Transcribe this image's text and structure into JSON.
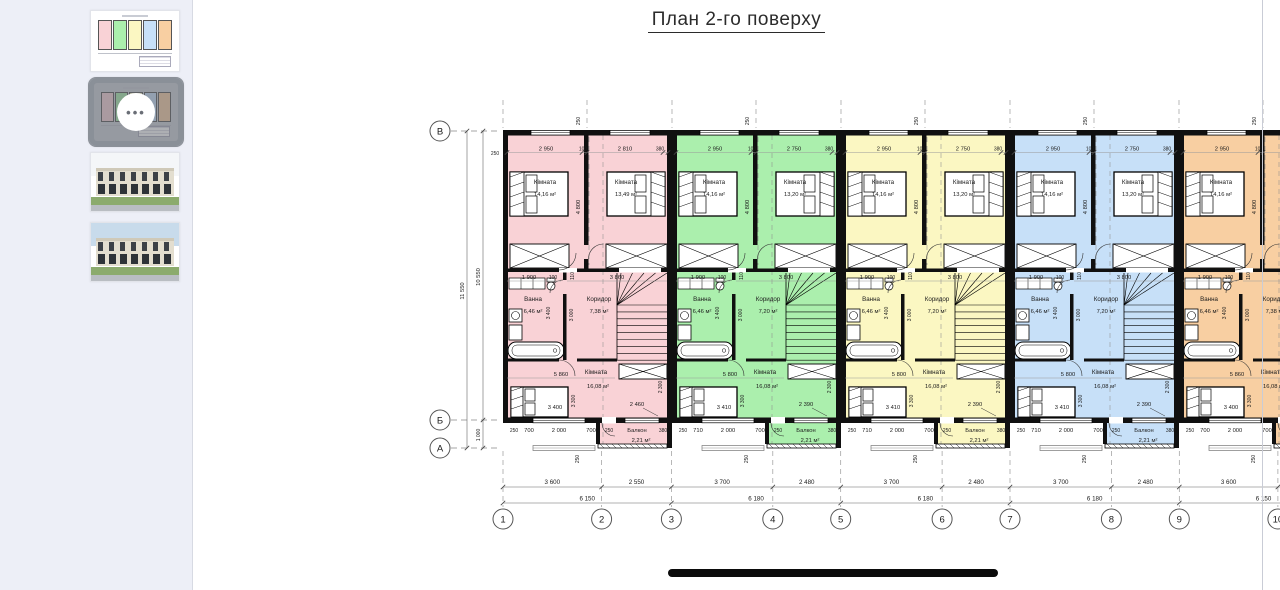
{
  "title": "План 2-го поверху",
  "watermark": {
    "letter": "M",
    "brand": "RIELTOR",
    "house_color": "#efa3af",
    "text_color": "#9b9b9b"
  },
  "icons": {
    "more_options": "•••"
  },
  "sidebar": {
    "selected_index": 1,
    "thumbnails": [
      {
        "kind": "plan"
      },
      {
        "kind": "plan-selected"
      },
      {
        "kind": "render-front"
      },
      {
        "kind": "render-perspective"
      }
    ]
  },
  "plan": {
    "vertical_axes": [
      "В",
      "Б",
      "А"
    ],
    "horizontal_axes": [
      "1",
      "2",
      "3",
      "4",
      "5",
      "6",
      "7",
      "8",
      "9",
      "10",
      "11"
    ],
    "left_dims": {
      "overall": "11 550",
      "main": "10 550",
      "balcony_row": "1 000",
      "wall": "250"
    },
    "bottom_dims_row1": [
      "3 600",
      "2 550",
      "3 700",
      "2 480",
      "3 700",
      "2 480",
      "3 700",
      "2 480",
      "3 600",
      "2 550"
    ],
    "bottom_dims_row2": [
      "6 150",
      "6 180",
      "6 180",
      "6 180",
      "6 150"
    ],
    "common": {
      "bedroom_depth": "4 800",
      "bath_top": [
        "1 900",
        "100"
      ],
      "wall_gap": "110",
      "bath_width": "3 400",
      "bath_depth": "3 000",
      "wall": "250"
    },
    "units": [
      {
        "color": "#f9d2d6",
        "top_dims": [
          "2 950",
          "100",
          "2 810",
          "380"
        ],
        "stairs_dim": "3 860",
        "bedroom1": {
          "name": "Кімната",
          "area": "14,16 м²"
        },
        "bedroom2": {
          "name": "Кімната",
          "area": "13,49 м²"
        },
        "bath": {
          "name": "Ванна",
          "area": "6,46 м²"
        },
        "corridor": {
          "name": "Коридор",
          "area": "7,38 м²"
        },
        "living": {
          "name": "Кімната",
          "area": "16,08 м²"
        },
        "balcony": {
          "name": "Балкон",
          "area": "2,21 м²"
        },
        "living_dims": {
          "top": "5 860",
          "bed": "3 400",
          "depth": "3 300",
          "balcony_top": "2 460",
          "right": "2 300"
        },
        "bottom_dims": [
          "250",
          "700",
          "2 000",
          "700",
          "250",
          "380"
        ]
      },
      {
        "color": "#abefad",
        "top_dims": [
          "2 950",
          "100",
          "2 750",
          "380"
        ],
        "stairs_dim": "3 800",
        "bedroom1": {
          "name": "Кімната",
          "area": "14,16 м²"
        },
        "bedroom2": {
          "name": "Кімната",
          "area": "13,20 м²"
        },
        "bath": {
          "name": "Ванна",
          "area": "6,46 м²"
        },
        "corridor": {
          "name": "Коридор",
          "area": "7,20 м²"
        },
        "living": {
          "name": "Кімната",
          "area": "16,08 м²"
        },
        "balcony": {
          "name": "Балкон",
          "area": "2,21 м²"
        },
        "living_dims": {
          "top": "5 800",
          "bed": "3 410",
          "depth": "3 300",
          "balcony_top": "2 390",
          "right": "2 300"
        },
        "bottom_dims": [
          "250",
          "710",
          "2 000",
          "700",
          "250",
          "380"
        ]
      },
      {
        "color": "#fbf7c2",
        "top_dims": [
          "2 950",
          "100",
          "2 750",
          "380"
        ],
        "stairs_dim": "3 800",
        "bedroom1": {
          "name": "Кімната",
          "area": "14,16 м²"
        },
        "bedroom2": {
          "name": "Кімната",
          "area": "13,20 м²"
        },
        "bath": {
          "name": "Ванна",
          "area": "6,46 м²"
        },
        "corridor": {
          "name": "Коридор",
          "area": "7,20 м²"
        },
        "living": {
          "name": "Кімната",
          "area": "16,08 м²"
        },
        "balcony": {
          "name": "Балкон",
          "area": "2,21 м²"
        },
        "living_dims": {
          "top": "5 800",
          "bed": "3 410",
          "depth": "3 300",
          "balcony_top": "2 390",
          "right": "2 300"
        },
        "bottom_dims": [
          "250",
          "710",
          "2 000",
          "700",
          "250",
          "380"
        ]
      },
      {
        "color": "#c7e0f8",
        "top_dims": [
          "2 950",
          "100",
          "2 750",
          "380"
        ],
        "stairs_dim": "3 800",
        "bedroom1": {
          "name": "Кімната",
          "area": "14,16 м²"
        },
        "bedroom2": {
          "name": "Кімната",
          "area": "13,20 м²"
        },
        "bath": {
          "name": "Ванна",
          "area": "6,46 м²"
        },
        "corridor": {
          "name": "Коридор",
          "area": "7,20 м²"
        },
        "living": {
          "name": "Кімната",
          "area": "16,08 м²"
        },
        "balcony": {
          "name": "Балкон",
          "area": "2,21 м²"
        },
        "living_dims": {
          "top": "5 800",
          "bed": "3 410",
          "depth": "3 300",
          "balcony_top": "2 390",
          "right": "2 300"
        },
        "bottom_dims": [
          "250",
          "710",
          "2 000",
          "700",
          "250",
          "380"
        ]
      },
      {
        "color": "#f8cfa2",
        "top_dims": [
          "2 950",
          "100",
          "2 810",
          "250"
        ],
        "stairs_dim": "3 860",
        "bedroom1": {
          "name": "Кімната",
          "area": "14,16 м²"
        },
        "bedroom2": {
          "name": "Кімната",
          "area": "13,49 м²"
        },
        "bath": {
          "name": "Ванна",
          "area": "6,46 м²"
        },
        "corridor": {
          "name": "Коридор",
          "area": "7,38 м²"
        },
        "living": {
          "name": "Кімната",
          "area": "16,08 м²"
        },
        "balcony": {
          "name": "Балкон",
          "area": "2,21 м²"
        },
        "living_dims": {
          "top": "5 860",
          "bed": "3 400",
          "depth": "3 300",
          "balcony_top": "2 460",
          "right": "2 300"
        },
        "bottom_dims": [
          "250",
          "700",
          "2 000",
          "700",
          "250",
          "380"
        ]
      }
    ]
  }
}
